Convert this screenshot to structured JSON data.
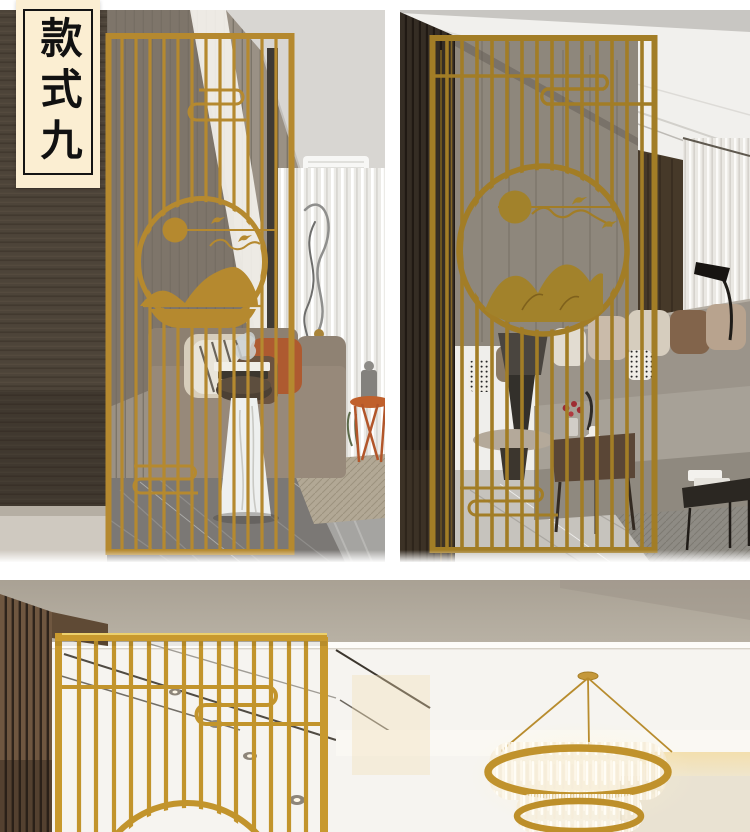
{
  "page": {
    "width": 750,
    "height": 832,
    "background": "#ffffff"
  },
  "style_badge": {
    "text": "款式九",
    "background": "#fbeed2",
    "border_color": "#141414",
    "text_color": "#111111"
  },
  "palette": {
    "brass_gold": "#b5892f",
    "brass_gold_dark": "#a27d26",
    "brass_gold_bright": "#c8992e",
    "badge_background": "#fbeed2",
    "page_background": "#ffffff"
  },
  "photos": [
    {
      "id": "top-left",
      "subject": "Gold metal screen partition with round mountain-and-sun medallion in a living room"
    },
    {
      "id": "top-right",
      "subject": "Gold metal screen partition beside a grey sectional sofa in a living room"
    },
    {
      "id": "bottom",
      "subject": "Gold metal screen partition in a hallway with a round crystal chandelier"
    }
  ]
}
